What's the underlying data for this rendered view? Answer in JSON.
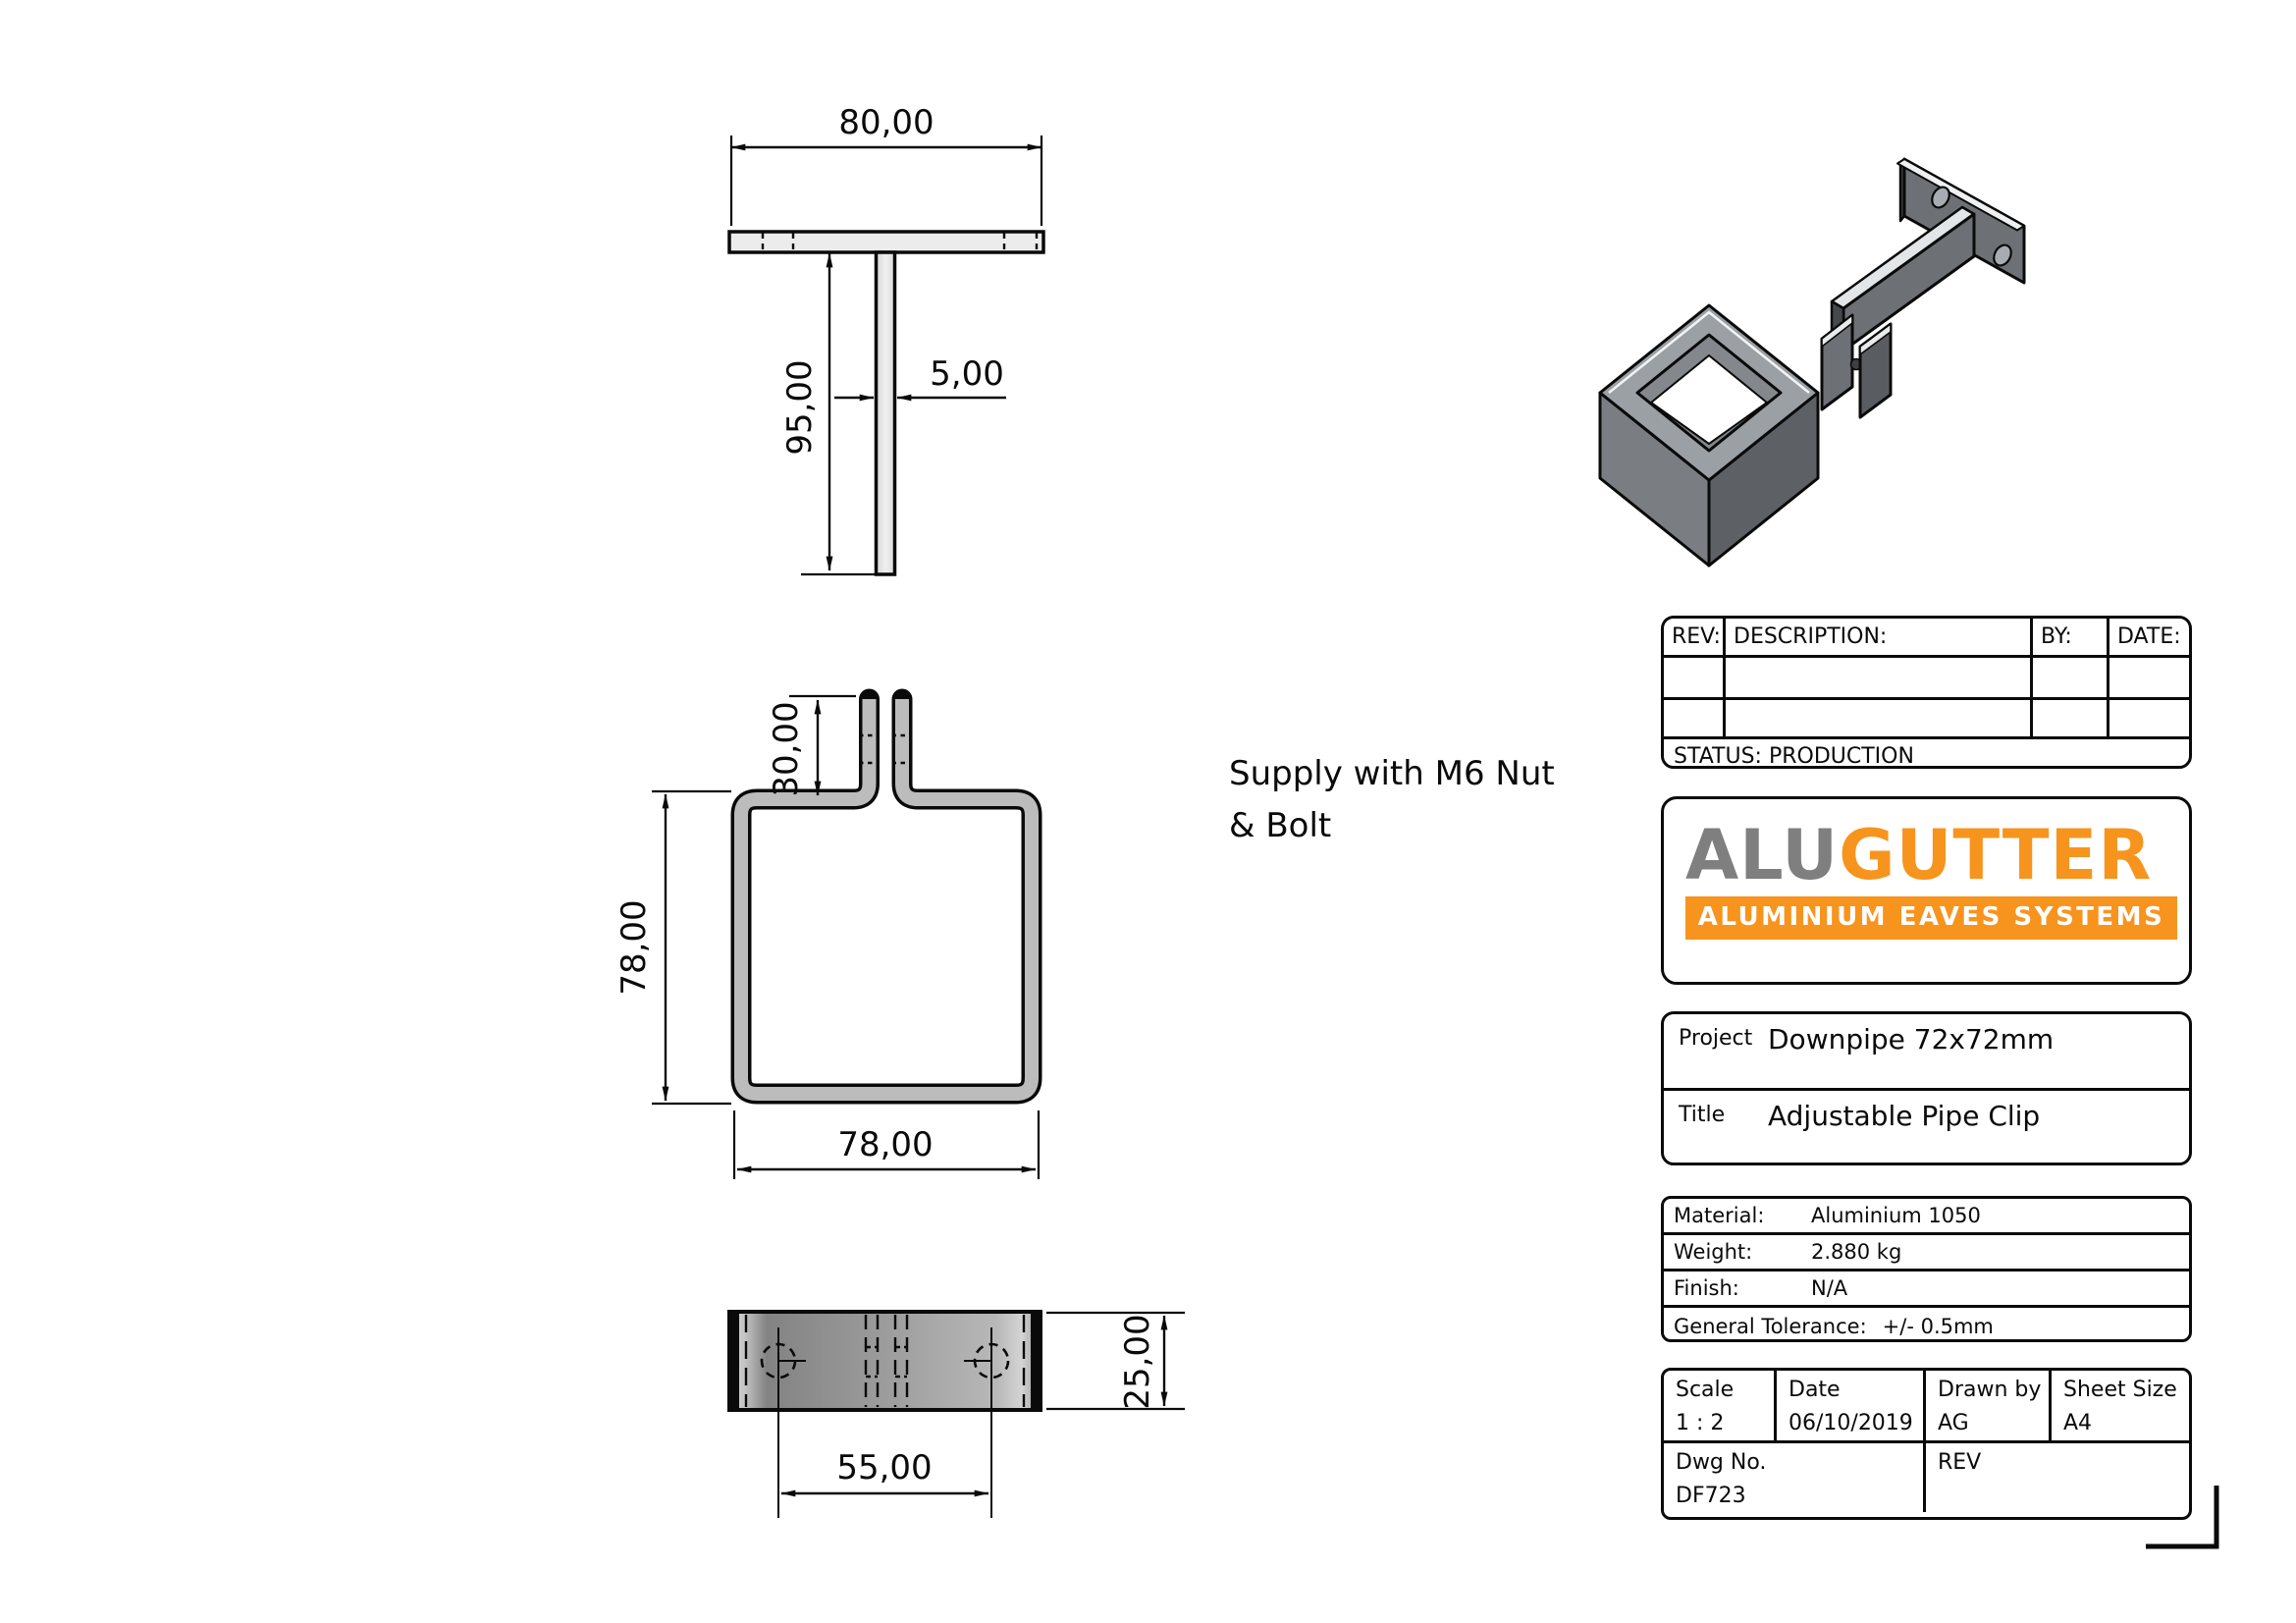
{
  "note": {
    "line1": "Supply with M6 Nut",
    "line2": "& Bolt"
  },
  "dims": {
    "top_width": "80,00",
    "stem_length": "95,00",
    "stem_thickness": "5,00",
    "prong_height": "30,00",
    "front_height": "78,00",
    "front_width": "78,00",
    "hole_spacing": "55,00",
    "depth": "25,00"
  },
  "rev_table": {
    "rev": "REV:",
    "description": "DESCRIPTION:",
    "by": "BY:",
    "date": "DATE:",
    "status": "STATUS: PRODUCTION"
  },
  "logo": {
    "alu": "ALU",
    "gutter": "GUTTER",
    "tagline": "ALUMINIUM EAVES SYSTEMS"
  },
  "project": {
    "label": "Project",
    "value": "Downpipe 72x72mm"
  },
  "part_title": {
    "label": "Title",
    "value": "Adjustable Pipe Clip"
  },
  "specs": [
    {
      "label": "Material:",
      "value": "Aluminium 1050"
    },
    {
      "label": "Weight:",
      "value": "2.880 kg"
    },
    {
      "label": "Finish:",
      "value": "N/A"
    },
    {
      "label": "General Tolerance:",
      "value": "+/- 0.5mm"
    }
  ],
  "info": {
    "scale_label": "Scale",
    "scale_value": "1 : 2",
    "date_label": "Date",
    "date_value": "06/10/2019",
    "drawn_label": "Drawn by",
    "drawn_value": "AG",
    "sheet_label": "Sheet Size",
    "sheet_value": "A4",
    "dwg_label": "Dwg No.",
    "dwg_value": "DF723",
    "rev_label": "REV"
  },
  "colors": {
    "brand_orange": "#F7941E",
    "brand_gray": "#7F7F7F",
    "line_black": "#0A0A0A",
    "profile_gray": "#BCBCBC"
  }
}
